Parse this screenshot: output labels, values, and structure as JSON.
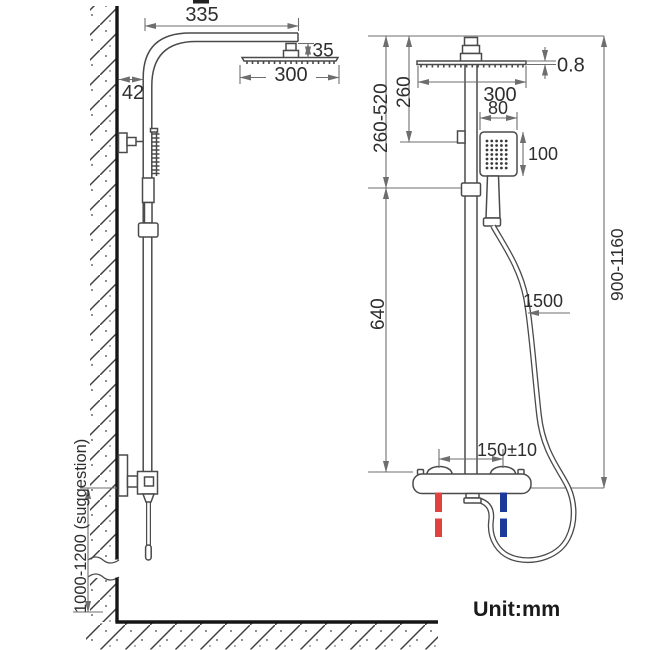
{
  "unit_label": "Unit:mm",
  "colors": {
    "hot_water": "#e2423e",
    "cold_water": "#1d3a9b",
    "outline": "#4a4a4a",
    "dimension_line": "#6e6e6e",
    "wall": "#161616"
  },
  "side_view": {
    "arm_length": "335",
    "wall_offset": "42",
    "connector_height": "35",
    "head_width": "300",
    "valve_floor_height": "1000-1200 (suggestion)"
  },
  "front_view": {
    "head_thickness": "0.8",
    "head_width": "300",
    "head_to_holder": "260",
    "holder_adjust_range": "260-520",
    "hand_shower_width": "80",
    "hand_shower_height": "100",
    "lower_section": "640",
    "overall_height": "900-1160",
    "hose_length": "1500",
    "inlet_spacing": "150±10"
  }
}
